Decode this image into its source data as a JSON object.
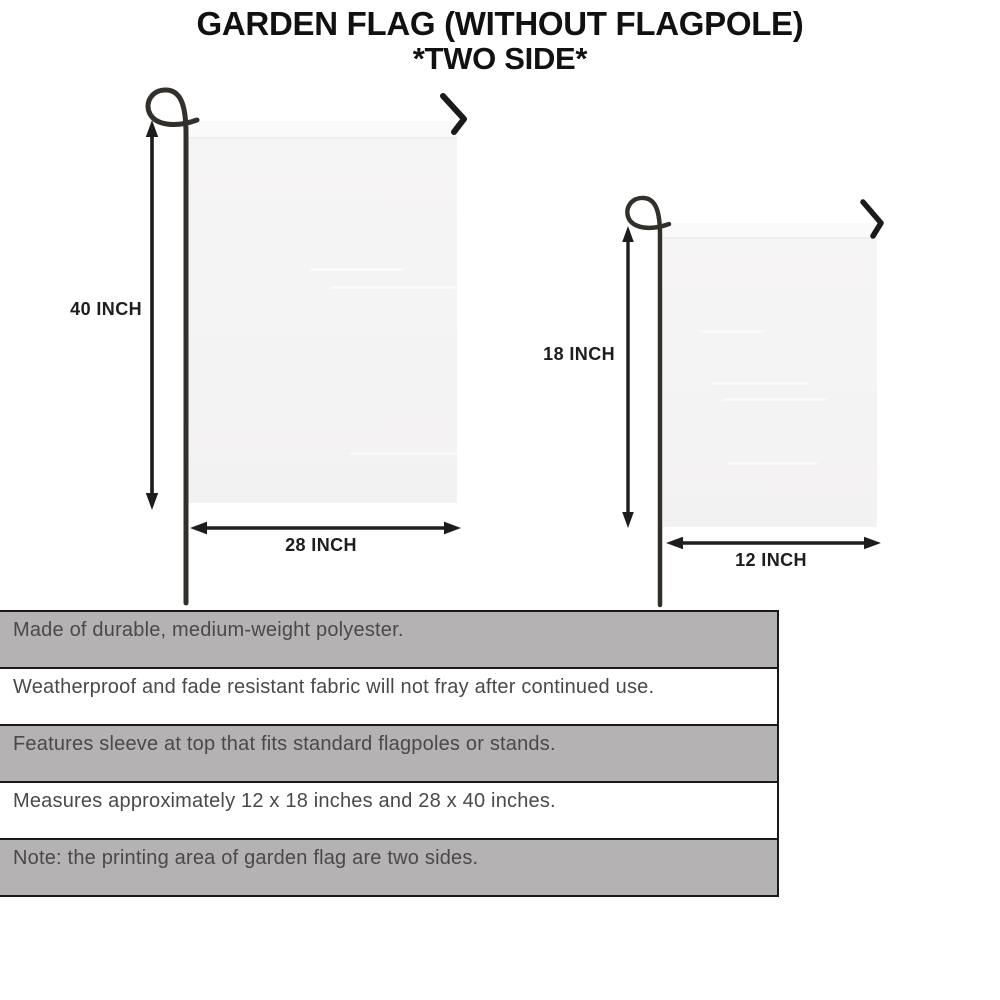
{
  "title": "GARDEN FLAG (WITHOUT FLAGPOLE)",
  "subtitle": "*TWO SIDE*",
  "diagram": {
    "large_flag": {
      "name": "28 x 40 inch garden flag",
      "height_label": "40 INCH",
      "width_label": "28 INCH"
    },
    "small_flag": {
      "name": "12 x 18 inch garden flag",
      "height_label": "18 INCH",
      "width_label": "12 INCH"
    }
  },
  "features": {
    "rows": [
      {
        "text": "Made of durable, medium-weight polyester.",
        "shaded": true
      },
      {
        "text": "Weatherproof and fade resistant fabric will not fray after continued use.",
        "shaded": false
      },
      {
        "text": "Features sleeve at top that fits standard flagpoles or stands.",
        "shaded": true
      },
      {
        "text": "Measures approximately 12 x 18 inches and 28 x 40 inches.",
        "shaded": false
      },
      {
        "text": "Note: the printing area of garden flag are two sides.",
        "shaded": true
      }
    ]
  },
  "colors": {
    "row_shaded": "#b5b2b3",
    "row_plain": "#ffffff",
    "row_border": "#1a1a1a",
    "row_text": "#4b484a",
    "title_ink": "#111111",
    "arrow_ink": "#1d1d1d",
    "flag_fill": "#f5f4f4",
    "pole": "#33302c"
  }
}
